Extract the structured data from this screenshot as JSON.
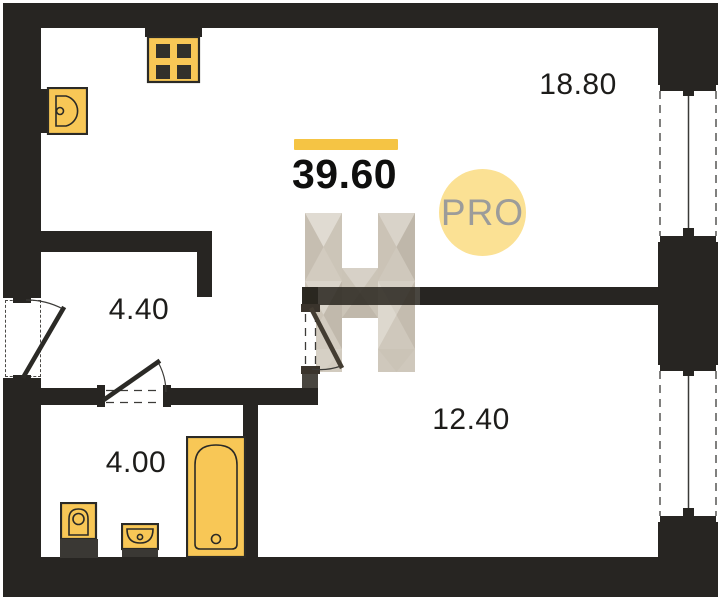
{
  "floorplan": {
    "total_area_label": "39.60",
    "badge_label": "PRO",
    "rooms": {
      "living": "18.80",
      "hall": "4.40",
      "bedroom": "12.40",
      "bath": "4.00"
    },
    "colors": {
      "wall": "#272522",
      "fixture_fill": "#F8C756",
      "fixture_stroke": "#2B2A26",
      "accent_bar": "#F5C444",
      "badge_fill": "#FBE194",
      "badge_text": "#9C9C9A",
      "label_text": "#1D1C1A",
      "watermark_light": "#E0DBD2",
      "watermark_mid": "#D2CBBF",
      "watermark_dark": "#C1B9AC"
    }
  }
}
